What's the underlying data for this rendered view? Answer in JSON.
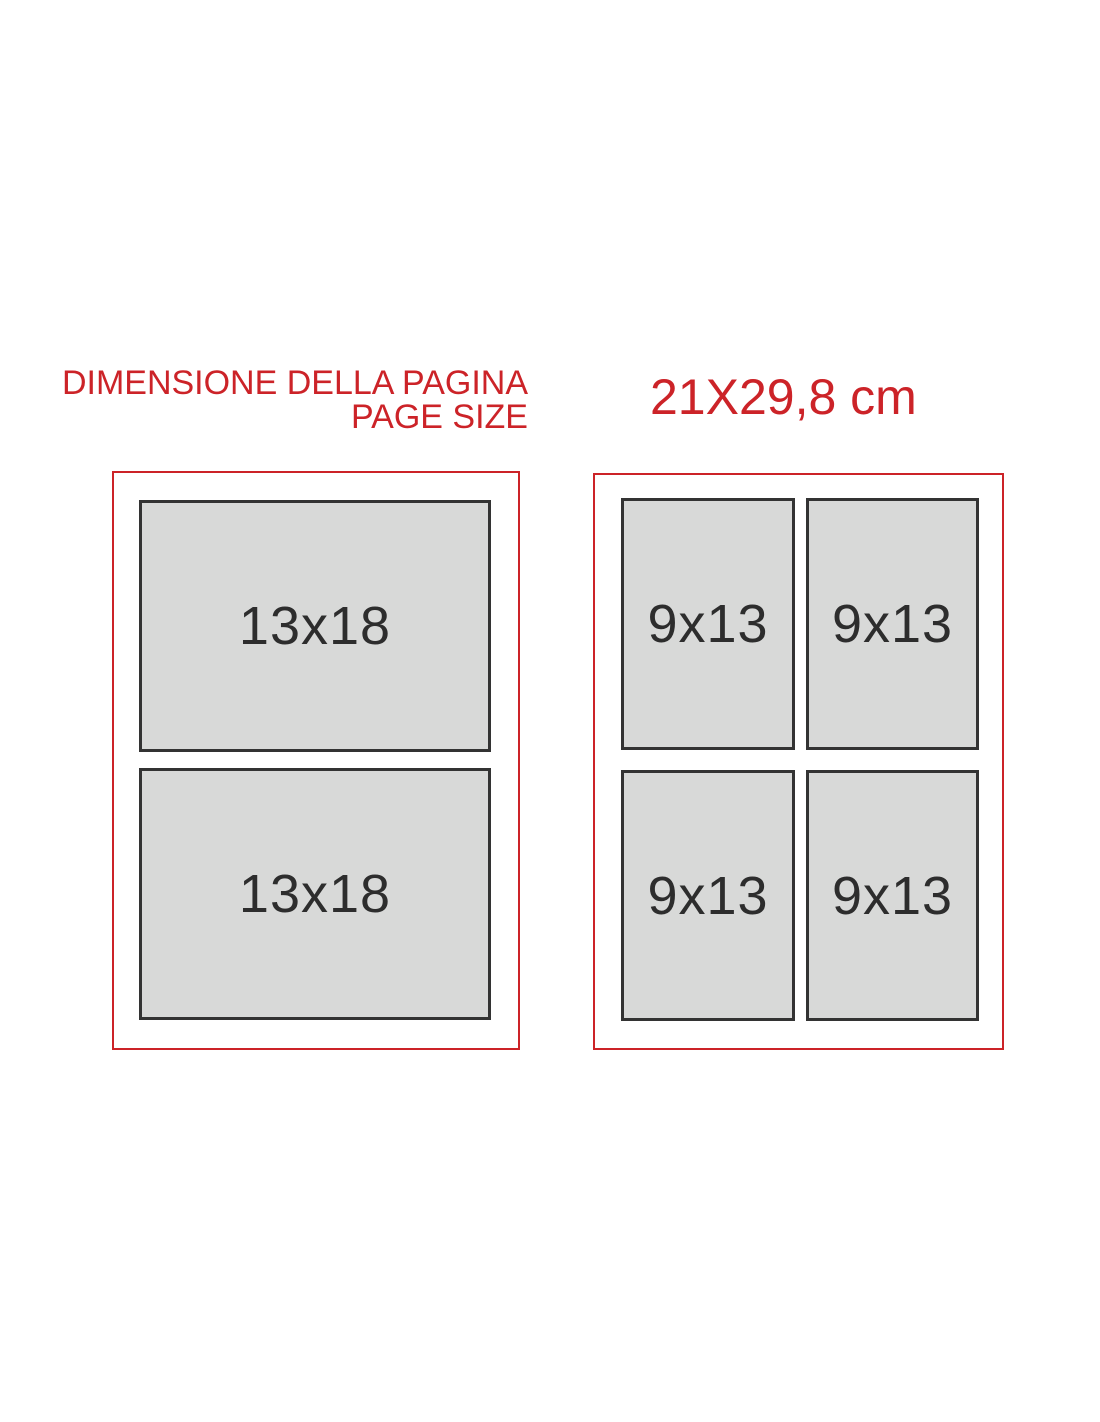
{
  "header": {
    "title_italian": "DIMENSIONE DELLA PAGINA",
    "title_english": "PAGE SIZE",
    "page_size": "21X29,8 cm"
  },
  "colors": {
    "accent_red": "#cc2328",
    "photo_fill": "#d8d9d8",
    "photo_border": "#333333",
    "label_text": "#2d2d2d"
  },
  "left_page": {
    "slots": [
      {
        "label": "13x18"
      },
      {
        "label": "13x18"
      }
    ]
  },
  "right_page": {
    "slots": [
      {
        "label": "9x13"
      },
      {
        "label": "9x13"
      },
      {
        "label": "9x13"
      },
      {
        "label": "9x13"
      }
    ]
  }
}
